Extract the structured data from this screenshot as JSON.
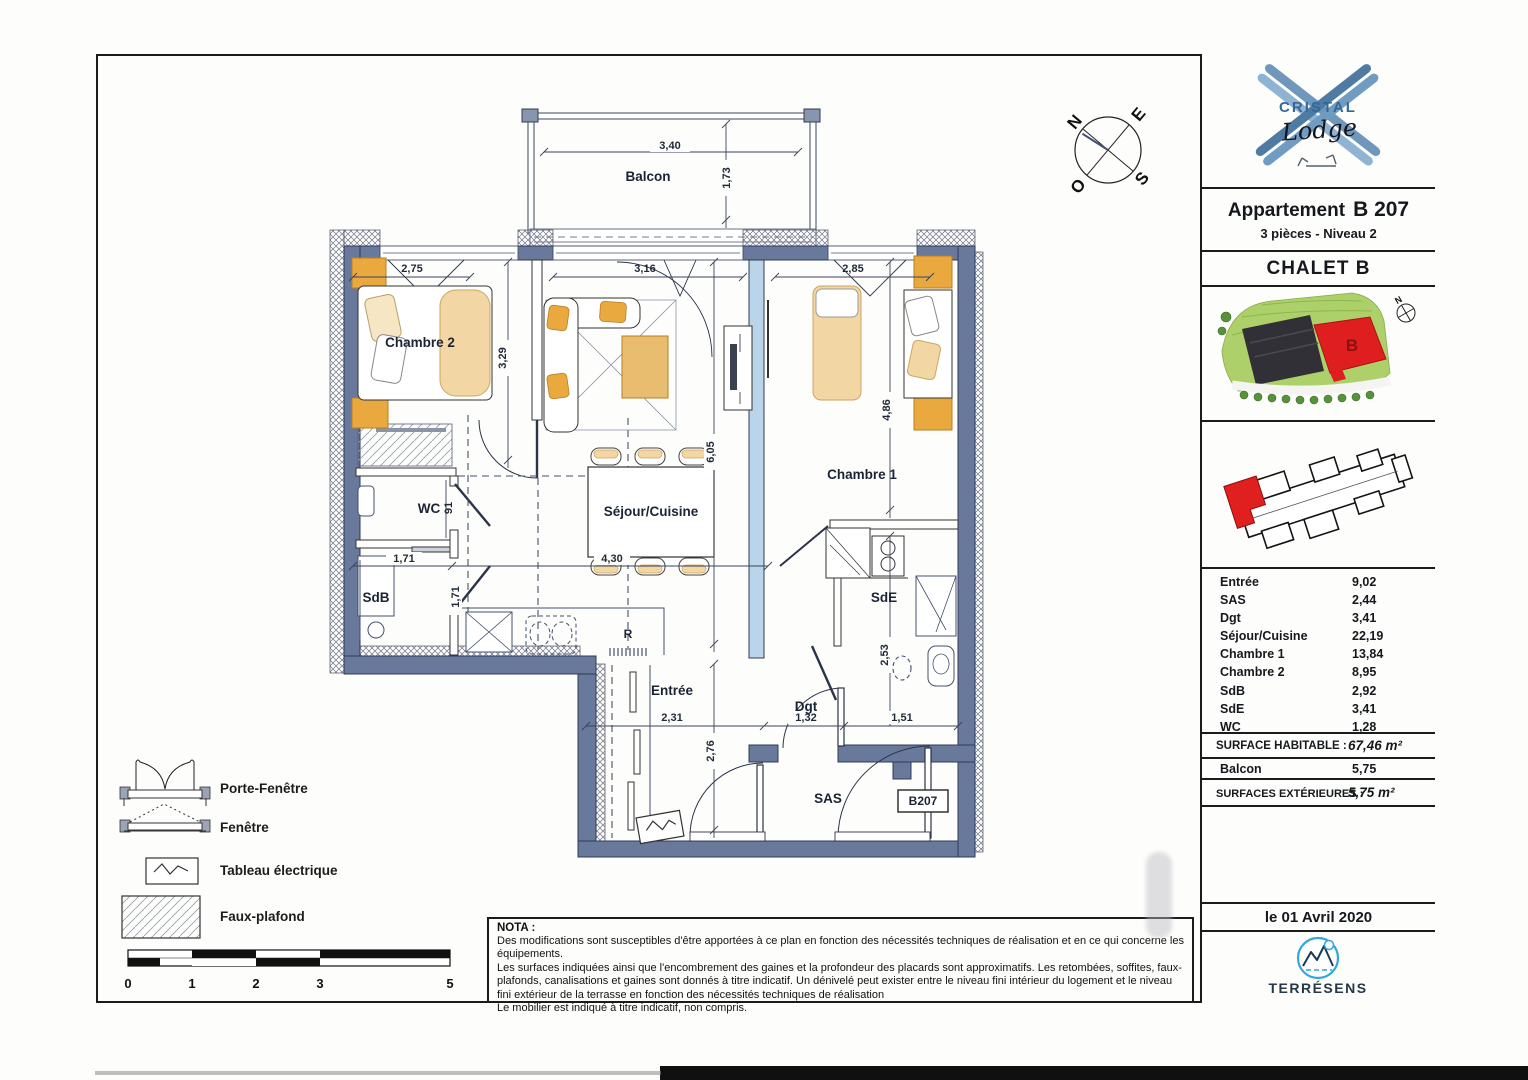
{
  "logo": {
    "brand": "CRISTAL",
    "script": "Lodge"
  },
  "header": {
    "apartment_label": "Appartement",
    "apartment_number": "B 207",
    "subtitle": "3 pièces  - Niveau 2",
    "chalet": "CHALET B"
  },
  "site_plan": {
    "building_label": "B",
    "compass_n": "N"
  },
  "areas": {
    "rows": [
      {
        "room": "Entrée",
        "value": "9,02"
      },
      {
        "room": "SAS",
        "value": "2,44"
      },
      {
        "room": "Dgt",
        "value": "3,41"
      },
      {
        "room": "Séjour/Cuisine",
        "value": "22,19"
      },
      {
        "room": "Chambre 1",
        "value": "13,84"
      },
      {
        "room": "Chambre 2",
        "value": "8,95"
      },
      {
        "room": "SdB",
        "value": "2,92"
      },
      {
        "room": "SdE",
        "value": "3,41"
      },
      {
        "room": "WC",
        "value": "1,28"
      }
    ],
    "surface_habitable_label": "SURFACE HABITABLE :",
    "surface_habitable_value": "67,46 m²",
    "balcon_room": "Balcon",
    "balcon_value": "5,75",
    "surfaces_ext_label": "SURFACES EXTÉRIEURES :",
    "surfaces_ext_value": "5,75 m²"
  },
  "date": "le 01 Avril 2020",
  "publisher": {
    "name": "TERRÉSENS"
  },
  "plan": {
    "rooms": {
      "balcon": "Balcon",
      "chambre2": "Chambre 2",
      "sejour": "Séjour/Cuisine",
      "chambre1": "Chambre 1",
      "wc": "WC",
      "sdb": "SdB",
      "sde": "SdE",
      "entree": "Entrée",
      "dgt": "Dgt",
      "sas": "SAS",
      "fridge": "R"
    },
    "unit_tag": "B207",
    "dims": {
      "balcon_w": "3,40",
      "balcon_d": "1,73",
      "ch2_w": "2,75",
      "sejour_w": "3,16",
      "ch1_w": "2,85",
      "ch2_h": "3,29",
      "sejour_h": "6,05",
      "ch1_h": "4,86",
      "wc_h": "91",
      "sdb_w": "1,71",
      "sdb_h": "1,71",
      "kitchen_w": "4,30",
      "entree_w": "2,31",
      "entree_h": "2,76",
      "dgt_w": "1,32",
      "sas_w": "1,51",
      "dgt_h": "2,53"
    },
    "compass": {
      "n": "N",
      "e": "E",
      "s": "S",
      "o": "O"
    }
  },
  "legend": {
    "items": [
      {
        "label": "Porte-Fenêtre"
      },
      {
        "label": "Fenêtre"
      },
      {
        "label": "Tableau électrique"
      },
      {
        "label": "Faux-plafond"
      }
    ],
    "scale_ticks": [
      "0",
      "1",
      "2",
      "3",
      "5"
    ]
  },
  "nota": {
    "heading": "NOTA :",
    "lines": [
      "Des modifications sont susceptibles d'être apportées à ce plan en fonction des nécessités techniques de réalisation et en ce qui concerne les équipements.",
      "Les surfaces indiquées ainsi que l'encombrement des gaines et la profondeur des placards sont approximatifs. Les retombées, soffites, faux-plafonds, canalisations et gaines sont donnés à titre indicatif. Un dénivelé peut exister entre le niveau fini intérieur du logement et le niveau fini extérieur de la terrasse en fonction des nécessités techniques de réalisation",
      "Le mobilier est indiqué à titre indicatif, non compris."
    ]
  },
  "colors": {
    "wall": "#68799b",
    "glass_partition": "#bad5ea",
    "furniture_tan": "#f2d7a4",
    "furniture_orange": "#e9a93f",
    "accent_red": "#df1f1f",
    "logo_blue": "#33689b",
    "terresens_blue": "#2fa7dc"
  }
}
